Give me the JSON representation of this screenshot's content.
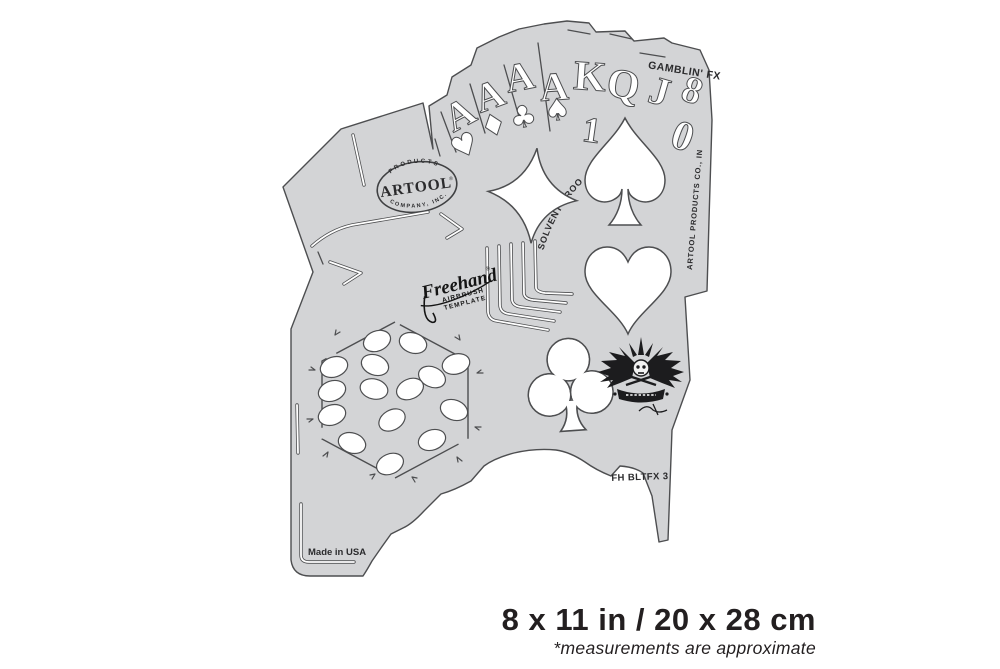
{
  "colors": {
    "stencil_fill": "#d3d4d6",
    "outline": "#4d4e50",
    "ink": "#231f20"
  },
  "stencil": {
    "series_label": "GAMBLIN' FX",
    "solvent_label": "SOLVENT PROOF",
    "side_label": "ARTOOL PRODUCTS CO., INC.",
    "sku": "FH BLTFX 3",
    "origin": "Made in USA",
    "brand": {
      "arc_top": "PRODUCTS",
      "name": "ARTOOL",
      "reg": "®",
      "arc_bottom": "COMPANY, INC."
    },
    "freehand": {
      "script": "Freehand",
      "reg": "®",
      "line1": "AIRBRUSH",
      "line2": "TEMPLATE"
    },
    "cards": {
      "letters": [
        "A",
        "A",
        "A",
        "A",
        "K",
        "Q",
        "J",
        "8"
      ],
      "digits": [
        "1",
        "0"
      ],
      "suits": [
        "♥",
        "♦",
        "♣",
        "♠"
      ]
    }
  },
  "caption": {
    "size": "8 x 11 in / 20 x 28 cm",
    "note": "*measurements are approximate"
  }
}
